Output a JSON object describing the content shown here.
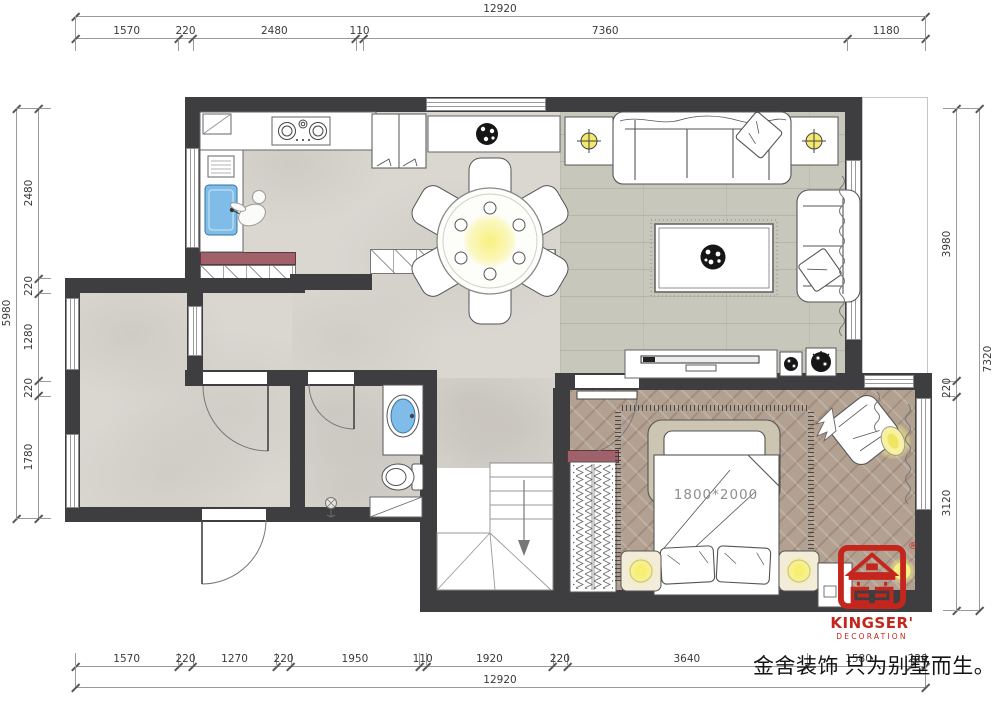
{
  "dimensions": {
    "top": {
      "total": "12920",
      "segments": [
        1570,
        220,
        2480,
        110,
        7360,
        1180
      ]
    },
    "bottom": {
      "total": "12920",
      "segments": [
        1570,
        220,
        1270,
        220,
        1950,
        110,
        1920,
        220,
        3640,
        1580,
        220
      ]
    },
    "left": {
      "total": "5980",
      "segments": [
        2480,
        220,
        1280,
        220,
        1780
      ]
    },
    "right": {
      "total": "7320",
      "segments": [
        3980,
        220,
        3120
      ]
    }
  },
  "labels": {
    "bed_size": "1800*2000"
  },
  "branding": {
    "logo_name": "KINGSER'",
    "logo_sub": "DECORATION",
    "registered": "®",
    "slogan": "金舍装饰 只为别墅而生。",
    "logo_color": "#c4261d"
  },
  "colors": {
    "wall": "#3e3e40",
    "tile_floor": "#dad7d1",
    "wood_floor": "#c7c7bb",
    "herringbone_floor": "#b2a091",
    "cabinet_accent": "#a2606a",
    "sink_blue": "#7fbde8",
    "lamp_yellow": "#f6ee8a"
  }
}
